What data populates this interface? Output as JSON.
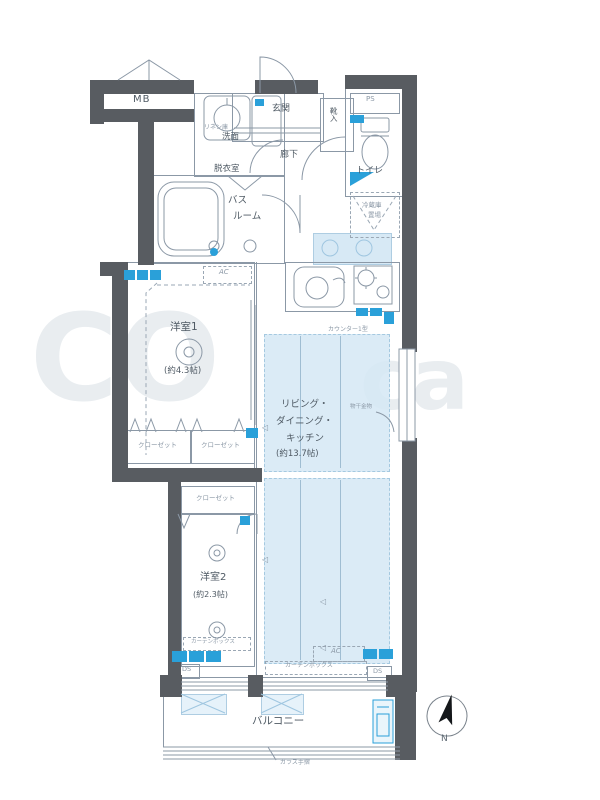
{
  "plan_title": "apartment-floor-plan",
  "colors": {
    "wall": "#585c61",
    "line": "#8b98a6",
    "light_blue_fill": "#d7e9f5",
    "accent_blue": "#2aa0d9",
    "label_text": "#4f5a64"
  },
  "labels": {
    "mb": "MB",
    "entrance": "玄関",
    "shoe_box": "靴入",
    "ps": "PS",
    "toilet": "トイレ",
    "corridor": "廊下",
    "linen": "リネン庫",
    "vanity": "洗面",
    "dressing_room": "脱衣室",
    "bath_line1": "バス",
    "bath_line2": "ルーム",
    "room1": "洋室1",
    "room1_size": "(約4.3帖)",
    "ldk_line1": "リビング・",
    "ldk_line2": "ダイニング・",
    "ldk_line3": "キッチン",
    "ldk_size": "(約13.7帖)",
    "room2": "洋室2",
    "room2_size": "(約2.3帖)",
    "closet1": "クローゼット",
    "closet2": "クローゼット",
    "closet3": "クローゼット",
    "fridge_line1": "冷蔵庫",
    "fridge_line2": "置場",
    "counter": "カウンター1型",
    "laundry_hardware": "物干金物",
    "curtain_box1": "カーテンボックス",
    "curtain_box2": "カーテンボックス",
    "ac1": "AC",
    "ac2": "AC",
    "ds1": "DS",
    "ds2": "DS",
    "balcony": "バルコニー",
    "glass_rail": "ガラス手摺",
    "north": "N"
  },
  "watermark": {
    "left": "CO",
    "right": "ca"
  }
}
